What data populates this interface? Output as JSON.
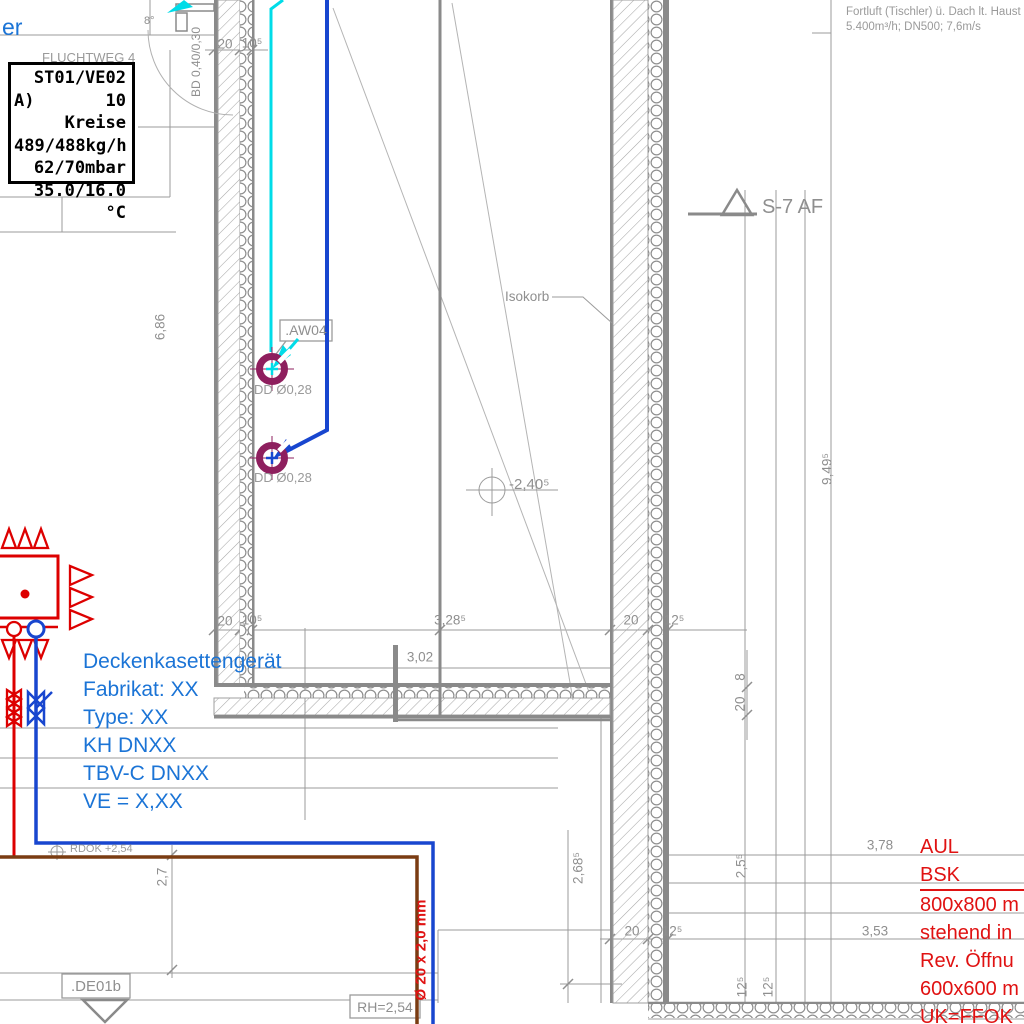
{
  "stamp": {
    "line1": "ST01/VE02",
    "line2_prefix": "A)",
    "line2": "10 Kreise",
    "line3": "489/488kg/h",
    "line4": "62/70mbar",
    "line5": "35.0/16.0 °C"
  },
  "hidden_text": "FLUCHTWEG 4",
  "fortluft": {
    "line1": "Fortluft (Tischler) ü. Dach lt. Haust",
    "line2": "5.400m³/h; DN500; 7,6m/s"
  },
  "labels": {
    "er_fragment": "er",
    "s7af": "S-7 AF",
    "isokorb": "Isokorb",
    "aw04": ".AW04",
    "dd1": "DD Ø0,28",
    "dd2": "DD Ø0,28",
    "level": "-2,40⁵",
    "bd": "BD 0,40/0,30",
    "de01b": ".DE01b",
    "rh": "RH=2,54",
    "rdok": "RDOK +2,54",
    "pipe": "Ø 20 x 2,0 mm",
    "angle8": "8°"
  },
  "blue_note": {
    "l1": "Deckenkasettengerät",
    "l2": "Fabrikat: XX",
    "l3": "Type: XX",
    "l4": "KH DNXX",
    "l5": "TBV-C DNXX",
    "l6": "VE = X,XX"
  },
  "red_note": {
    "l1": "AUL BSK",
    "l2": "800x800 m",
    "l3": "stehend in",
    "l4": "Rev. Öffnu",
    "l5": "600x600 m",
    "l6": "UK=FFOK"
  },
  "dims": {
    "top_20": "20",
    "top_10": "10⁵",
    "v_686": "6,86",
    "v_949": "9,49⁵",
    "mid_20": "20",
    "mid_10": "10⁵",
    "mid_328": "3,28⁵",
    "mid_302": "3,02",
    "mid_w20": "20",
    "mid_125": "12⁵",
    "chain_8": "8",
    "chain_20": "20",
    "v_268": "2,68⁵",
    "v_25": "2,5⁵",
    "h_378": "3,78",
    "h_353": "3,53",
    "bw_20": "20",
    "bw_125": "12⁵",
    "b_125a": "12⁵",
    "b_125b": "12⁵",
    "v_27": "2,7"
  },
  "colors": {
    "annotation_blue": "#1b74d6",
    "annotation_red": "#e01212",
    "pipe_cyan": "#00dce8",
    "pipe_blue": "#1846cf",
    "pipe_brown": "#7a3c12",
    "pipe_red": "#dd0000",
    "symbol_purple": "#8e1f5e",
    "line_gray": "#8f8f8f"
  }
}
